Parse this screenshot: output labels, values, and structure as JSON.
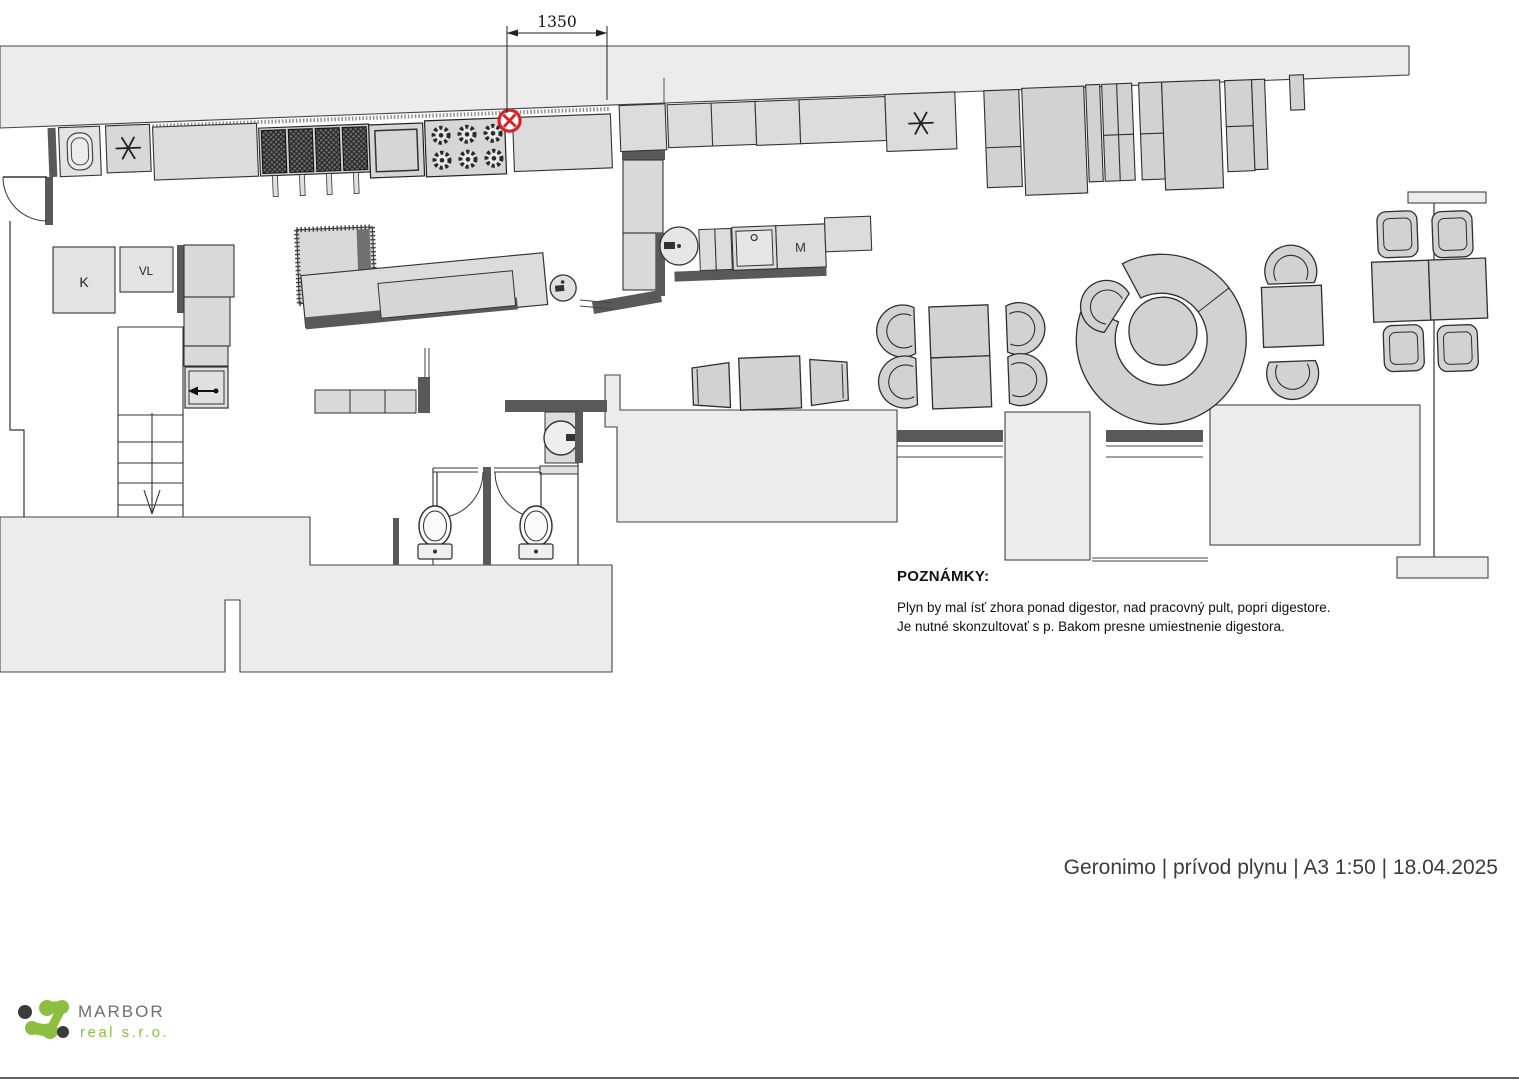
{
  "title_block": {
    "text": "Geronimo | prívod plynu | A3 1:50 | 18.04.2025"
  },
  "notes": {
    "heading": "POZNÁMKY:",
    "lines": [
      "Plyn by mal ísť zhora ponad digestor, nad pracovný pult, popri digestore.",
      "Je nutné skonzultovať s p. Bakom presne umiestnenie digestora."
    ]
  },
  "drawing": {
    "dimension_label": "1350",
    "room_labels": {
      "k": "K",
      "vl": "VL",
      "m": "M"
    }
  },
  "logo": {
    "name": "MARBOR",
    "subtitle": "real s.r.o."
  },
  "symbols": {
    "gas_point": "circled-x-gas-connection",
    "vent_left": "asterisk",
    "vent_right": "asterisk"
  },
  "colors": {
    "gas_point_red": "#d6232b",
    "logo_green": "#8cbf3f",
    "logo_gray": "#6d6e71",
    "mass_fill": "#ececec",
    "furniture_fill": "#d2d2d2",
    "wall_dark": "#595959"
  }
}
